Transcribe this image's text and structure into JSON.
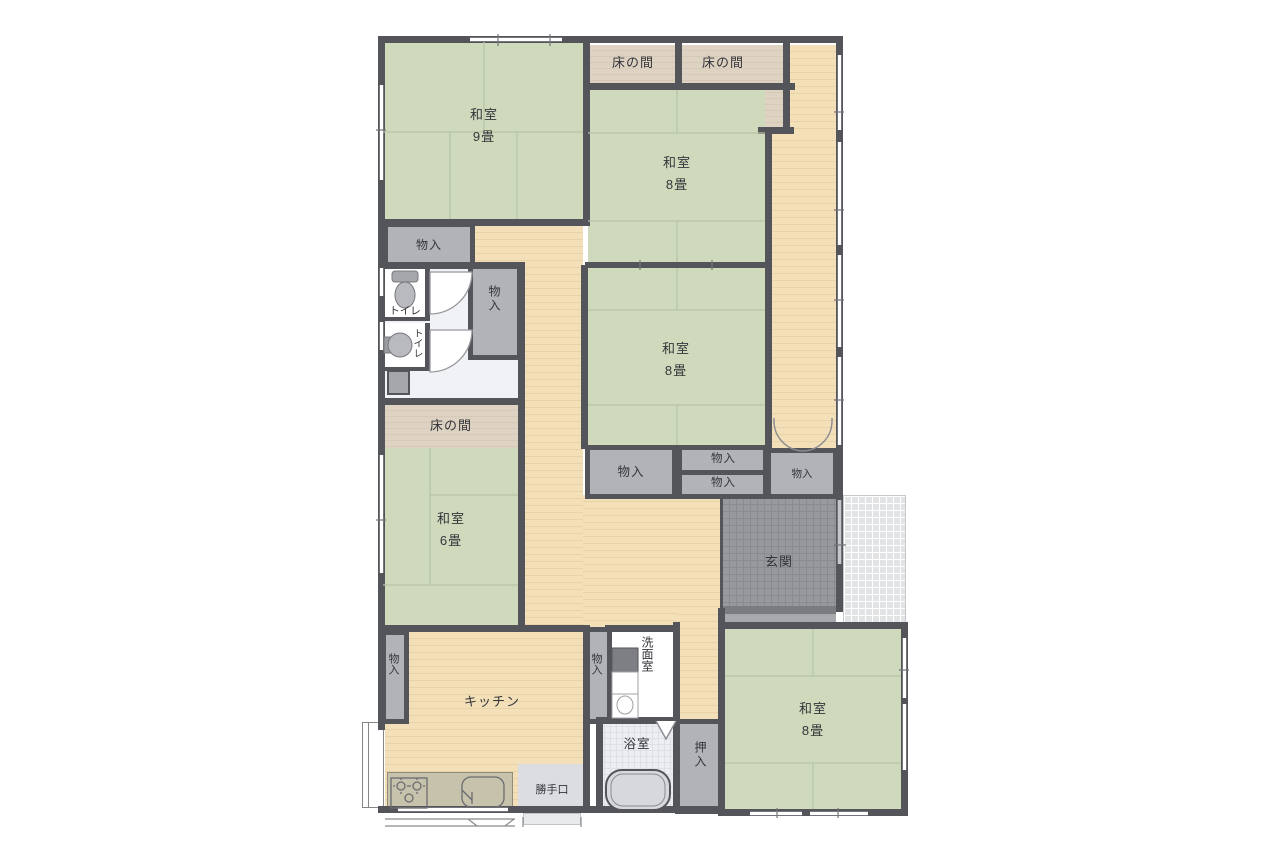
{
  "title": "Japanese house floor plan",
  "labels": {
    "washitsu": "和室",
    "size9": "9畳",
    "size8": "8畳",
    "size6": "6畳",
    "tokonoma": "床の間",
    "storage": "物入",
    "toilet": "トイレ",
    "genkan": "玄関",
    "kitchen": "キッチン",
    "senmen": "洗面室",
    "bath": "浴室",
    "katteguchi": "勝手口",
    "oshiire": "押入"
  },
  "rooms": [
    {
      "name": "和室",
      "size": "9畳"
    },
    {
      "name": "和室",
      "size": "8畳"
    },
    {
      "name": "和室",
      "size": "8畳"
    },
    {
      "name": "和室",
      "size": "6畳"
    },
    {
      "name": "和室",
      "size": "8畳"
    },
    {
      "name": "キッチン"
    },
    {
      "name": "玄関"
    },
    {
      "name": "洗面室"
    },
    {
      "name": "浴室"
    },
    {
      "name": "勝手口"
    },
    {
      "name": "押入"
    },
    {
      "name": "トイレ"
    },
    {
      "name": "トイレ"
    },
    {
      "name": "床の間"
    },
    {
      "name": "床の間"
    },
    {
      "name": "床の間"
    },
    {
      "name": "物入"
    }
  ],
  "colors": {
    "wall": "#54555a",
    "tatami": "#cfd9bb",
    "tatami_line": "#b7c4a5",
    "wood": "#f3dfb8",
    "wood2": "#e8d3a9",
    "tokonoma": "#ded3c3",
    "tokonoma2": "#d6c9b7",
    "storage": "#b2b3b6",
    "genkan": "#98999d",
    "porch": "#e2e3e5"
  }
}
